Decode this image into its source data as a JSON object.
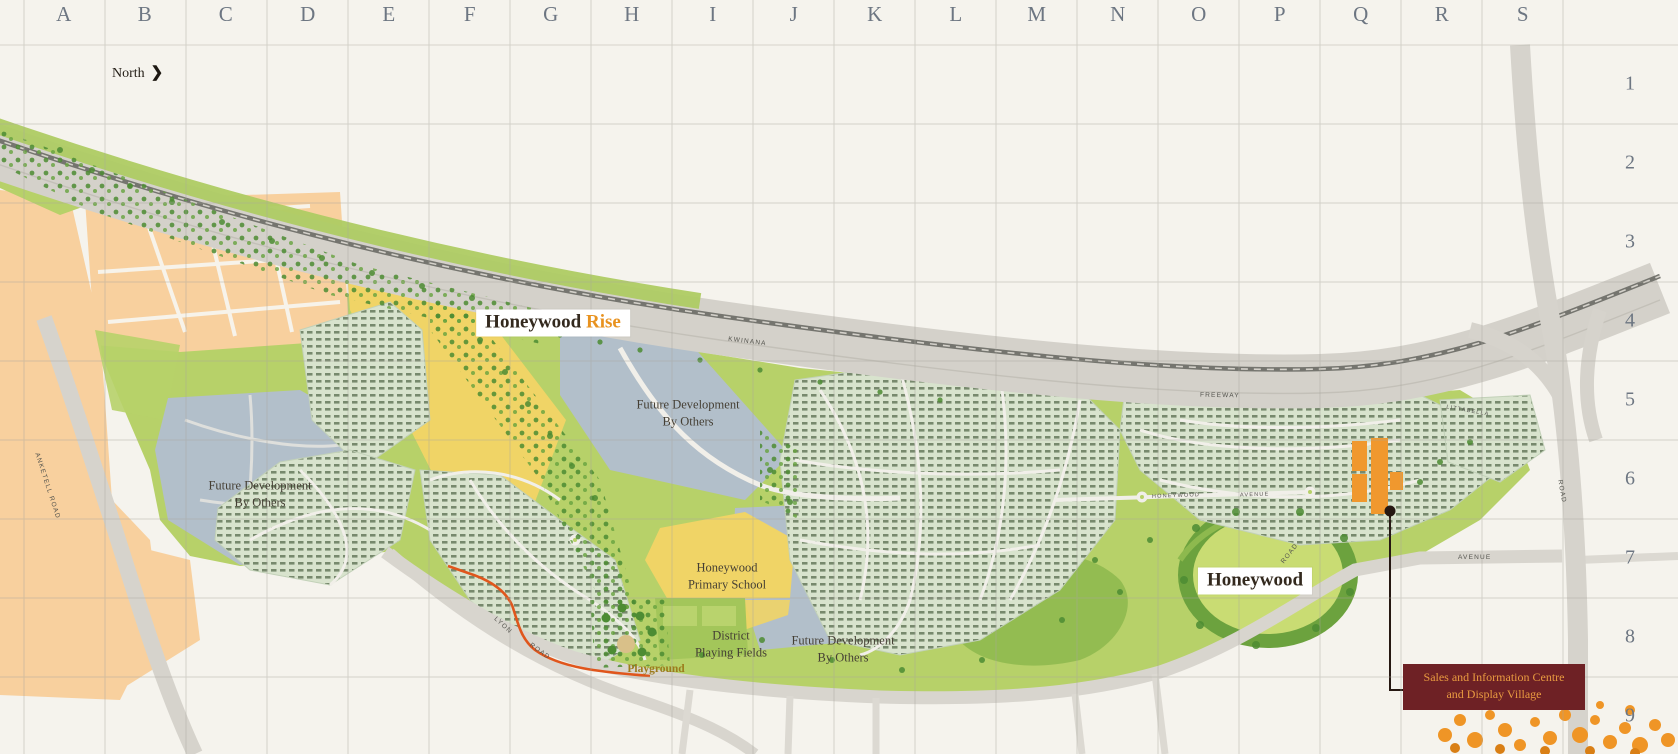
{
  "grid": {
    "columns": [
      "A",
      "B",
      "C",
      "D",
      "E",
      "F",
      "G",
      "H",
      "I",
      "J",
      "K",
      "L",
      "M",
      "N",
      "O",
      "P",
      "Q",
      "R",
      "S"
    ],
    "rows": [
      "1",
      "2",
      "3",
      "4",
      "5",
      "6",
      "7",
      "8",
      "9"
    ]
  },
  "compass": {
    "label": "North",
    "arrow": "❯"
  },
  "labels": {
    "honeywood_rise_1": "Honeywood",
    "honeywood_rise_2": "Rise",
    "honeywood": "Honeywood",
    "future_development": [
      "Future Development",
      "By Others"
    ],
    "school": [
      "Honeywood",
      "Primary School"
    ],
    "playing_fields": [
      "District",
      "Playing Fields"
    ],
    "playground": "Playground"
  },
  "callout": {
    "line1": "Sales and Information Centre",
    "line2": "and Display Village"
  },
  "road_labels": {
    "kwinana": "KWINANA",
    "freeway": "FREEWAY",
    "anketell": "ANKETELL ROAD",
    "lyon": "LYON",
    "lyon_road": "ROAD",
    "south_road": "ROAD",
    "bertram": "ROAD",
    "honeywood_avenue_1": "HONEYWOOD",
    "honeywood_avenue_2": "AVENUE",
    "littabella": "LITTABELLA",
    "avenue": "AVENUE"
  },
  "colors": {
    "map_cream": "#f5f3ed",
    "accent_orange": "#e8921f",
    "callout_bg": "#6e2125",
    "callout_text": "#e89a40",
    "display_village_orange": "#f0982e",
    "trail_orange": "#e0561c",
    "parkland_green": "#b7d169",
    "parcel_yellow": "#f0d466",
    "parcel_bluegray": "#b2bfca",
    "existing_suburb_peach": "#f8d09e"
  }
}
